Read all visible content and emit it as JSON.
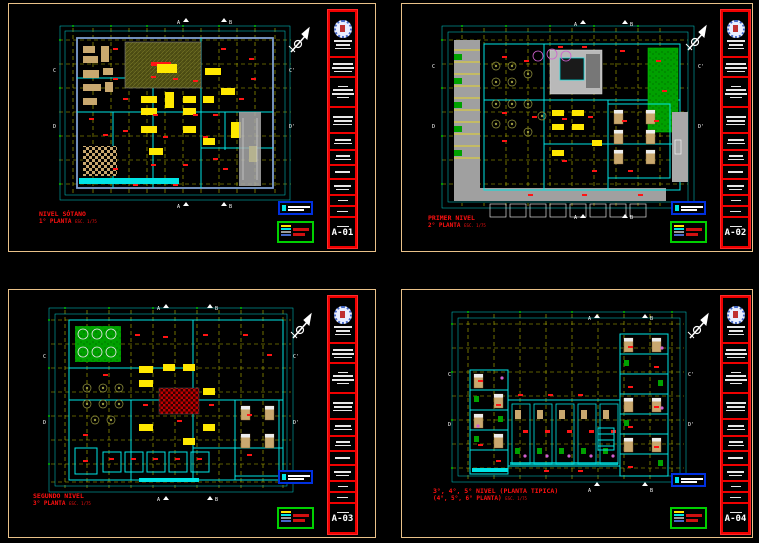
{
  "app": {
    "type": "cad-plot-multisheet",
    "background": "#000000"
  },
  "palette": {
    "sheet_border": "#E9C189",
    "titleblock_red": "#F00000",
    "grid_yellow": "#B9B900",
    "wall_cyan": "#00E5E5",
    "wall_blue": "#7F9FD0",
    "furniture_yellow": "#FFE800",
    "label_red": "#FF1414",
    "lawn_green": "#00A000",
    "legend_border_blue": "#0030E0",
    "legend_border_green": "#00D000",
    "road_gray": "#A0A0A0",
    "wood_tan": "#C9A86F",
    "table_magenta": "#D060D0",
    "white": "#FFFFFF"
  },
  "sheets": [
    {
      "number": "A-01",
      "caption_line1": "NIVEL SÓTANO",
      "caption_line2": "1° PLANTA",
      "caption_scale": "ESC. 1/75",
      "markers": {
        "top": [
          "A",
          "B"
        ],
        "bottom": [
          "A",
          "B"
        ],
        "left": [
          "C",
          "D"
        ],
        "right": [
          "C'",
          "D'"
        ]
      }
    },
    {
      "number": "A-02",
      "caption_line1": "PRIMER NIVEL",
      "caption_line2": "2° PLANTA",
      "caption_scale": "ESC. 1/75",
      "markers": {
        "top": [
          "A",
          "B"
        ],
        "bottom": [
          "A",
          "B"
        ],
        "left": [
          "C",
          "D"
        ],
        "right": [
          "C'",
          "D'"
        ]
      }
    },
    {
      "number": "A-03",
      "caption_line1": "SEGUNDO NIVEL",
      "caption_line2": "3° PLANTA",
      "caption_scale": "ESC. 1/75",
      "markers": {
        "top": [
          "A",
          "B"
        ],
        "bottom": [
          "A",
          "B"
        ],
        "left": [
          "C",
          "D"
        ],
        "right": [
          "C'",
          "D'"
        ]
      }
    },
    {
      "number": "A-04",
      "caption_line1": "3°, 4°, 5° NIVEL (PLANTA TIPICA)",
      "caption_line2": "(4°, 5°, 6° PLANTA)",
      "caption_scale": "ESC. 1/75",
      "markers": {
        "top": [
          "A",
          "B"
        ],
        "bottom": [
          "A",
          "B"
        ],
        "left": [
          "C",
          "D"
        ],
        "right": [
          "C'",
          "D'"
        ]
      }
    }
  ]
}
